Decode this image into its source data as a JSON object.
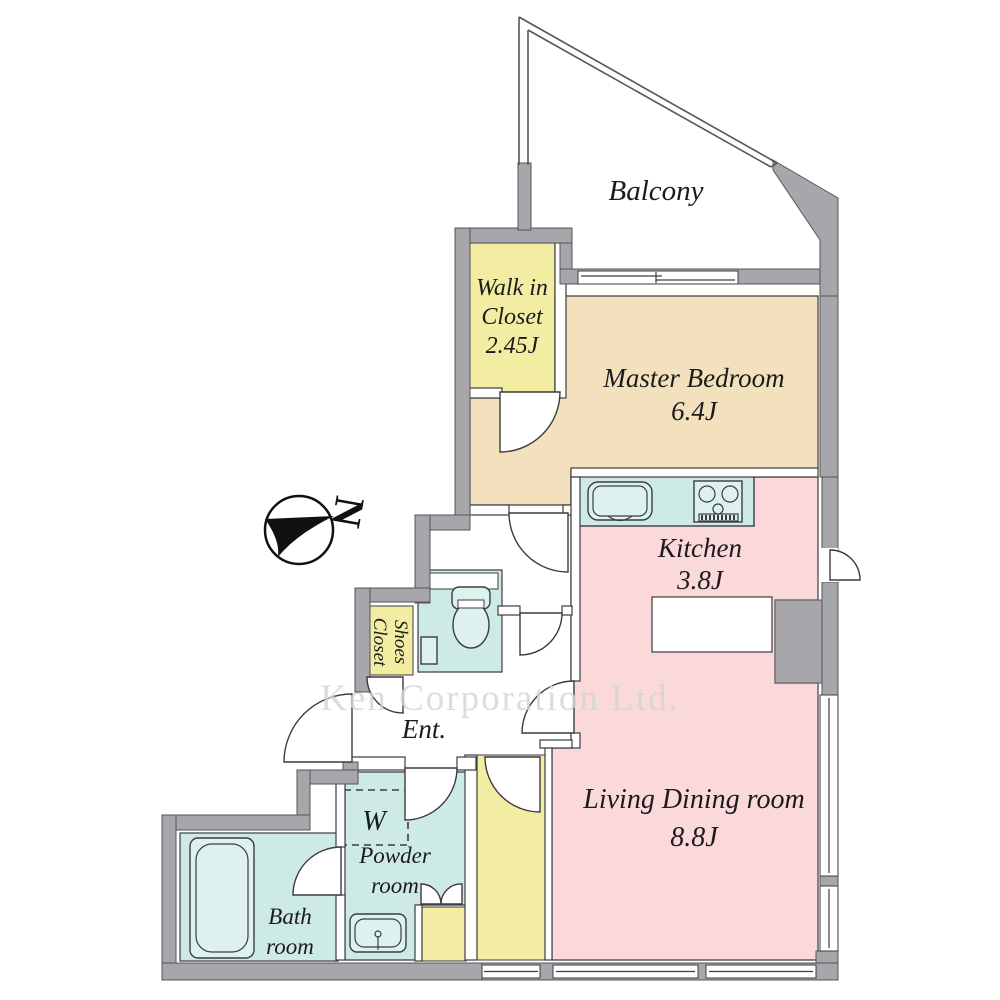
{
  "watermark": "Ken Corporation Ltd.",
  "compass": {
    "north_label": "N"
  },
  "rooms": {
    "balcony": {
      "name": "Balcony"
    },
    "walk_in_closet": {
      "name_line1": "Walk in",
      "name_line2": "Closet",
      "area": "2.45J"
    },
    "master_bedroom": {
      "name": "Master Bedroom",
      "area": "6.4J"
    },
    "kitchen": {
      "name": "Kitchen",
      "area": "3.8J"
    },
    "living_dining": {
      "name": "Living Dining room",
      "area": "8.8J"
    },
    "entrance": {
      "name": "Ent."
    },
    "shoes_closet": {
      "name_line1": "Shoes",
      "name_line2": "Closet"
    },
    "powder_room": {
      "name_line1": "Powder",
      "name_line2": "room"
    },
    "bath_room": {
      "name_line1": "Bath",
      "name_line2": "room"
    },
    "washer": {
      "symbol": "W"
    }
  },
  "colors": {
    "wall": "#a7a7ab",
    "wall_edge": "#56565a",
    "line": "#3c3c40",
    "yellow": "#f2eda3",
    "tan": "#f3e1bd",
    "pink": "#fbd9db",
    "teal": "#cdeae6",
    "fixture": "#ddf1ee",
    "text": "#1b1b1b",
    "watermark": "#d4d4d4"
  }
}
